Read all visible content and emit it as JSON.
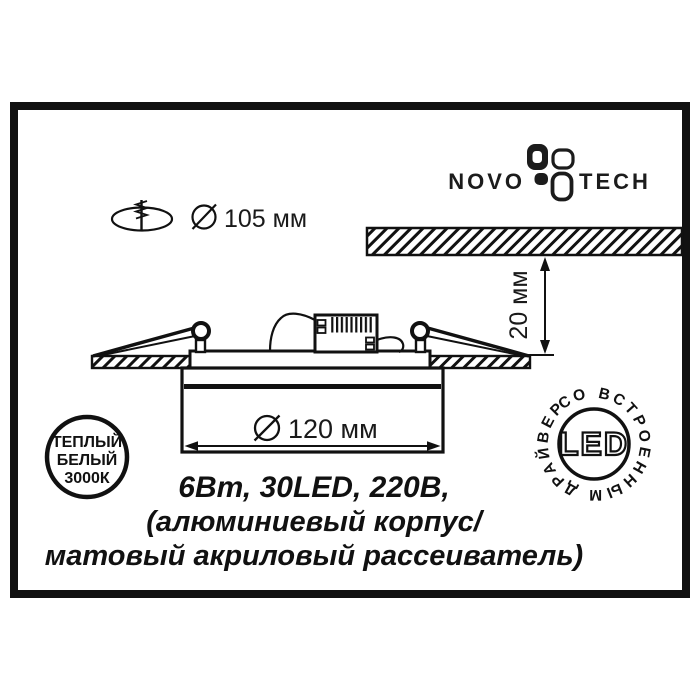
{
  "title": "Novotech recessed LED panel spec sheet",
  "logo": {
    "word_left": "NOVO",
    "word_right": "TECH",
    "mark": "pinwheel-leaves-icon"
  },
  "cutout": {
    "icon": "drill-hole-icon",
    "label": "105 мм",
    "symbol": "diameter-sign"
  },
  "depth": {
    "label": "20 мм",
    "symbol": "double-arrow-vertical"
  },
  "diameter": {
    "label": "120 мм",
    "symbol": "diameter-sign"
  },
  "specs": {
    "line1": "6Вт, 30LED, 220В,",
    "line2": "(алюминиевый корпус/",
    "line3": "матовый акриловый рассеиватель)"
  },
  "badge_color_temp": {
    "line1": "ТЕПЛЫЙ",
    "line2": "БЕЛЫЙ",
    "line3": "3000К"
  },
  "badge_led": {
    "center_label": "LED",
    "ring_label": "СО ВСТРОЕННЫМ ДРАЙВЕРОМ"
  },
  "colors": {
    "ink": "#111111",
    "paper": "#ffffff"
  }
}
